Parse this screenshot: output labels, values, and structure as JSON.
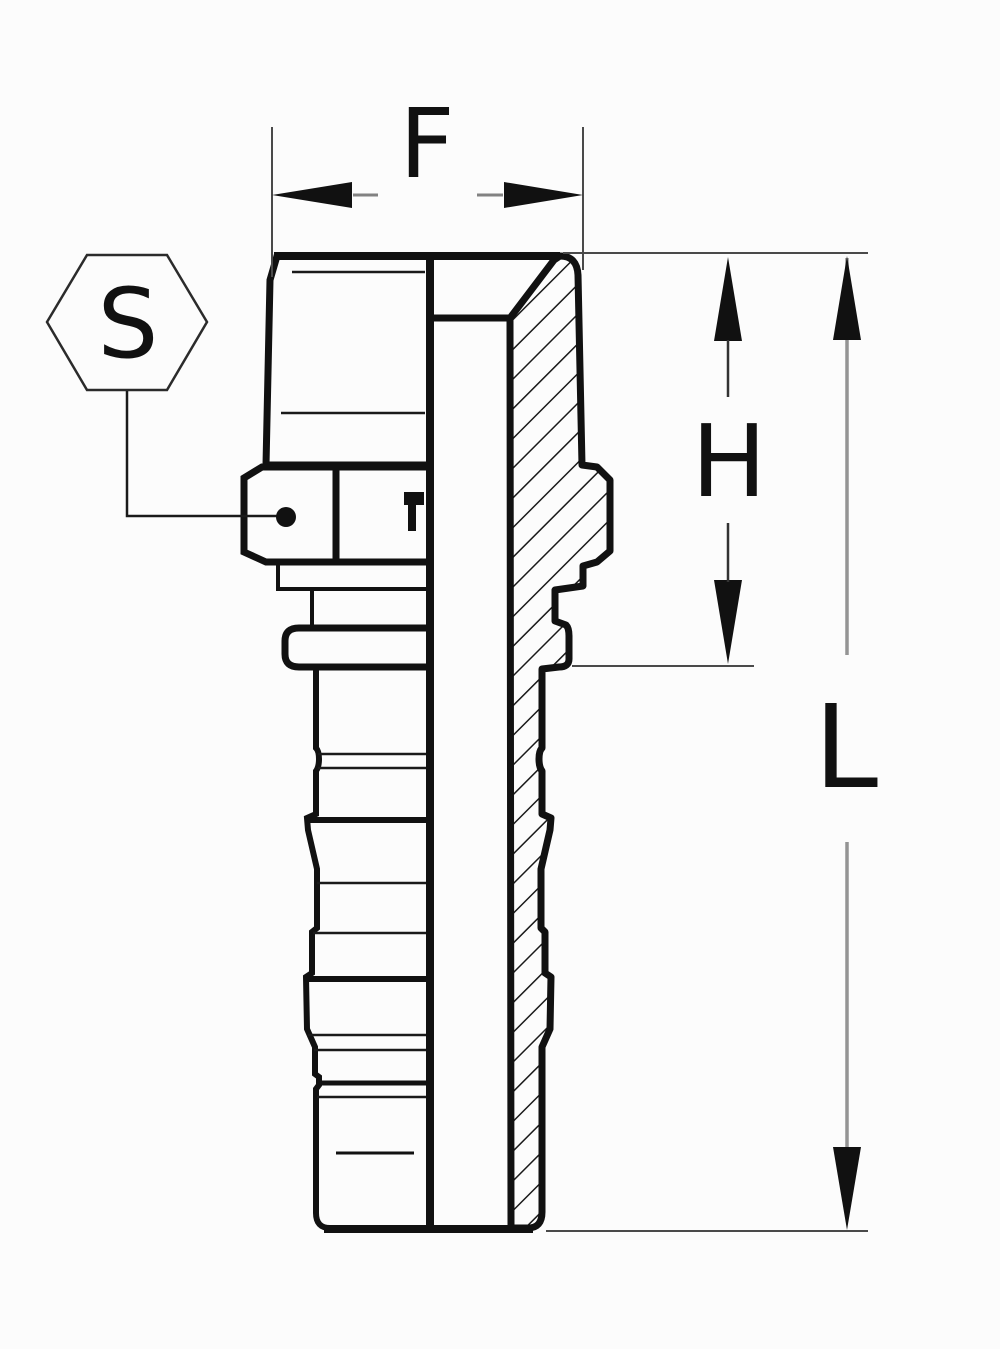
{
  "drawing": {
    "kind": "half-section technical drawing of a male-threaded hose barb fitting",
    "labels": {
      "f": "F",
      "s": "S",
      "h": "H",
      "l": "L"
    },
    "colors": {
      "outline": "#111111",
      "hatch": "#1a1a1a",
      "dimension_line": "#4a4a4a",
      "dimension_tail": "#333333",
      "length_line": "#949494",
      "arrowhead": "#111111",
      "background": "#fcfcfc"
    }
  }
}
